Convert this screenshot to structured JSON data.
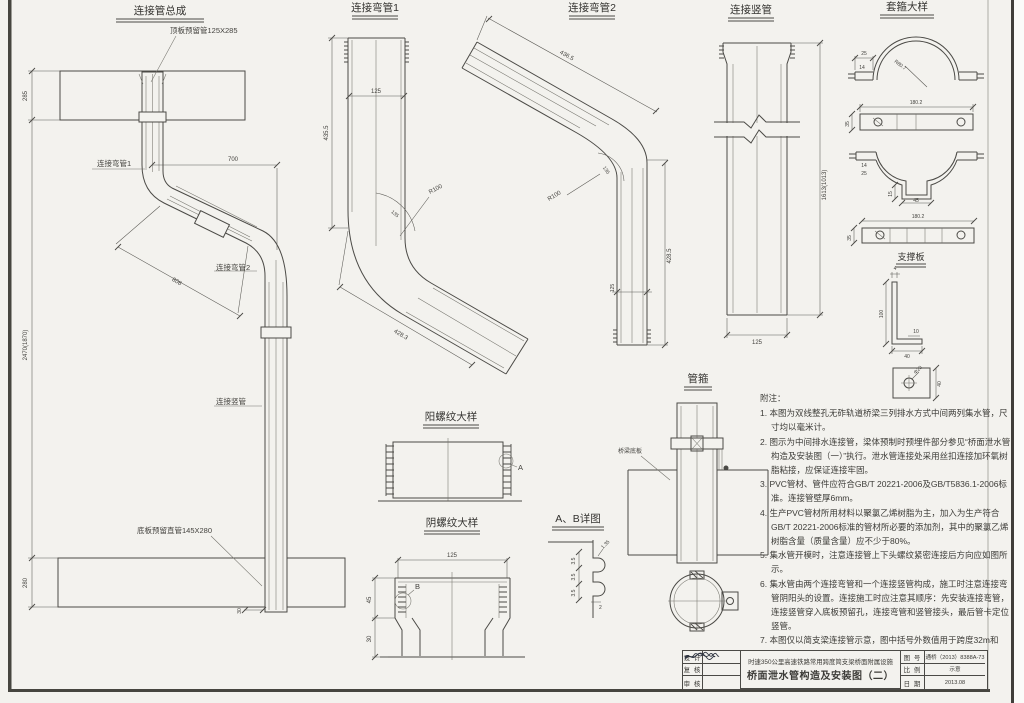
{
  "views": {
    "assembly": {
      "title": "连接管总成",
      "label_top_sleeve": "顶板预留管125X285",
      "label_bend1": "连接弯管1",
      "label_bend2": "连接弯管2",
      "label_vertical": "连接竖管",
      "label_bottom_sleeve": "底板预留直管145X280",
      "dim_top_slab": "285",
      "dim_horizontal": "700",
      "dim_diagonal": "808",
      "dim_height": "2470(1870)",
      "dim_bottom_slab": "280",
      "dim_offset": "30"
    },
    "bend1": {
      "title": "连接弯管1",
      "dim_width": "125",
      "dim_height": "435.5",
      "dim_radius": "R100",
      "dim_angle": "135",
      "dim_diagonal": "428.3"
    },
    "bend2": {
      "title": "连接弯管2",
      "dim_diagonal": "436.5",
      "dim_radius": "R100",
      "dim_angle": "135",
      "dim_height": "428.5",
      "dim_width": "125"
    },
    "vpipe": {
      "title": "连接竖管",
      "dim_height": "1613(1013)",
      "dim_width": "125"
    },
    "hoop": {
      "title": "套箍大样",
      "dim_tab_w": "25",
      "dim_tab_h": "14",
      "dim_radius": "R80.7",
      "dim_bar_len": "180.2",
      "dim_bar_h": "35",
      "dim_tab_h2": "14",
      "dim_tab_w2": "25",
      "dim_notch_h": "15",
      "dim_notch_w": "45",
      "dim_bar_len2": "180.2",
      "dim_bar_h2": "35"
    },
    "support": {
      "title": "支撑板",
      "dim_thk": "4",
      "dim_h": "100",
      "dim_thk2": "10",
      "dim_w": "40",
      "dim_hole": "Φ20",
      "dim_side": "40"
    },
    "male": {
      "title": "阳螺纹大样",
      "callout": "A"
    },
    "female": {
      "title": "阴螺纹大样",
      "dim_width": "125",
      "dim_h1": "45",
      "dim_h2": "30",
      "callout": "B"
    },
    "ab": {
      "title": "A、B详图",
      "dim_p1": "3.5",
      "dim_p2": "3.5",
      "dim_p3": "3.5",
      "dim_lead": "1.35",
      "dim_t": "2"
    },
    "clamp": {
      "title": "管箍",
      "label_slab": "桥梁底板"
    }
  },
  "notes": {
    "header": "附注：",
    "items": [
      "1. 本图为双线整孔无砟轨道桥梁三列排水方式中间两列集水管，尺寸均以毫米计。",
      "2. 图示为中间排水连接管，梁体预制时预埋件部分参见“桥面泄水管构造及安装图（一）”执行。泄水管连接处采用丝扣连接加环氧树脂粘接，应保证连接牢固。",
      "3. PVC管材、管件应符合GB/T 20221-2006及GB/T5836.1-2006标准。连接管壁厚6mm。",
      "4. 生产PVC管材所用材料以聚氯乙烯树脂为主，加入为生产符合GB/T 20221-2006标准的管材所必要的添加剂，其中的聚氯乙烯树脂含量（质量含量）应不少于80%。",
      "5. 集水管开模时，注意连接管上下头螺纹紧密连接后方向应如图所示。",
      "6. 集水管由两个连接弯管和一个连接竖管构成，施工时注意连接弯管阴阳头的设置。连接施工时应注意其顺序：先安装连接弯管，连接竖管穿入底板预留孔，连接弯管和竖管接头，最后管卡定位竖管。",
      "7. 本图仅以简支梁连接管示意，图中括号外数值用于跨度32m和24m（高）梁，括号内数值用于24m（低）和20m梁。"
    ]
  },
  "title_block": {
    "sign_rows": [
      {
        "label": "设 计"
      },
      {
        "label": "复 核"
      },
      {
        "label": "审 核"
      }
    ],
    "project_line1": "时速350公里高速铁路常用跨度简支梁桥面附属设施",
    "drawing_title": "桥面泄水管构造及安装图（二）",
    "fields": [
      {
        "label": "图 号",
        "value": "通桥（2013）8388A-73"
      },
      {
        "label": "比 例",
        "value": "示意"
      },
      {
        "label": "日 期",
        "value": "2013.08"
      }
    ]
  }
}
